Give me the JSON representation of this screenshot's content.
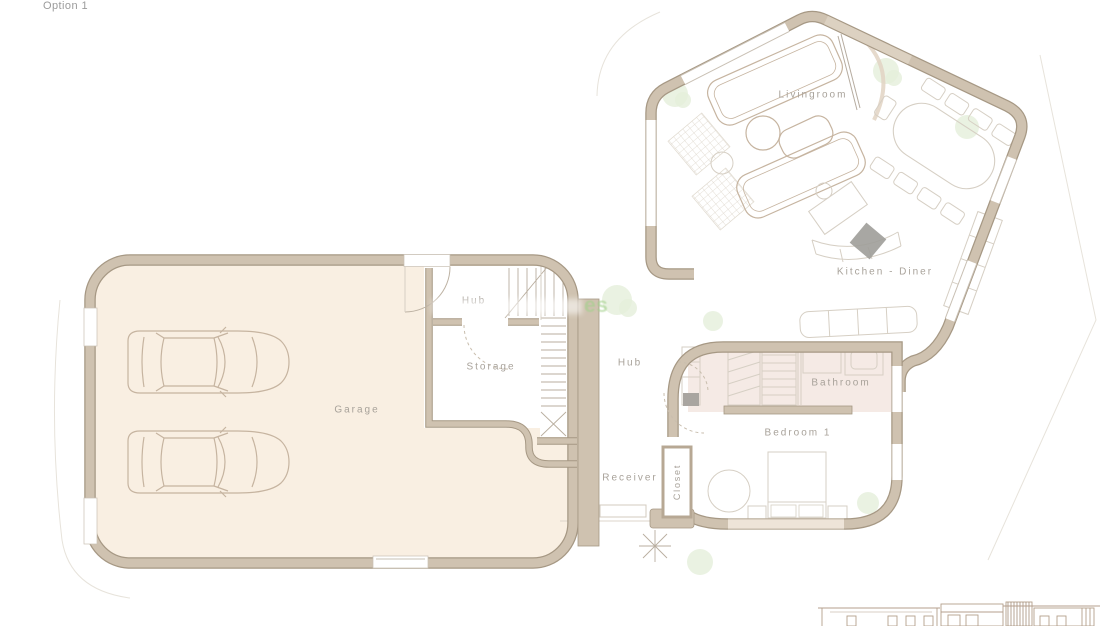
{
  "page": {
    "title": "Option 1",
    "watermark": "es"
  },
  "floorplan": {
    "rooms": [
      {
        "id": "garage",
        "label": "Garage"
      },
      {
        "id": "hub-upper",
        "label": "Hub"
      },
      {
        "id": "storage",
        "label": "Storage"
      },
      {
        "id": "livingroom",
        "label": "Livingroom"
      },
      {
        "id": "kitchen-diner",
        "label": "Kitchen - Diner"
      },
      {
        "id": "hub-lower",
        "label": "Hub"
      },
      {
        "id": "bathroom",
        "label": "Bathroom"
      },
      {
        "id": "bedroom-1",
        "label": "Bedroom 1"
      },
      {
        "id": "receiver",
        "label": "Receiver"
      },
      {
        "id": "closet",
        "label": "Closet"
      }
    ]
  },
  "colors": {
    "wall": "#cfc2b0",
    "wallEdge": "#a69884",
    "garageFloor": "#f9efe2",
    "bathFloor": "#f5eae5",
    "furniture": "#c6b4a0",
    "lightLine": "#d6cfc4",
    "label": "#a8a29a",
    "plant": "#e5efdb",
    "title": "#9b9b9b",
    "darkAccent": "#9f9d99",
    "watermarkGreen": "#a3d18c"
  }
}
